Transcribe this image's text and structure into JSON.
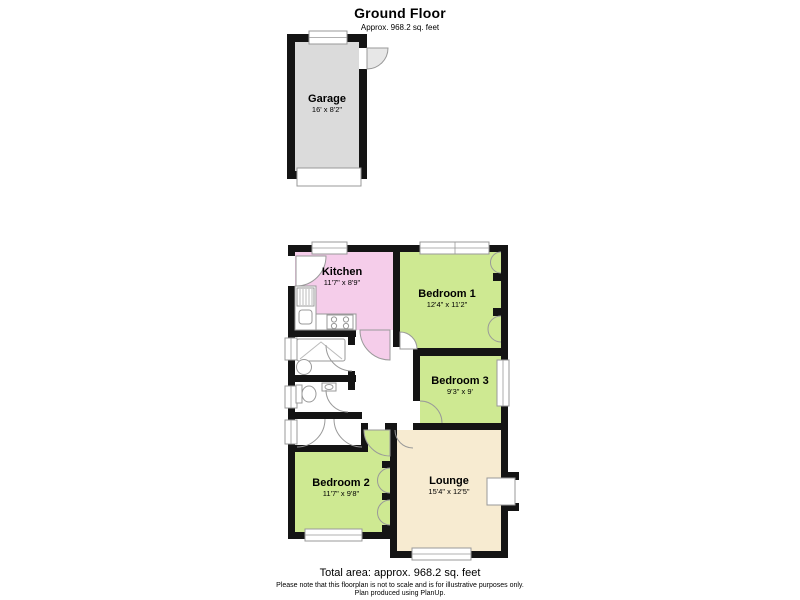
{
  "header": {
    "title": "Ground Floor",
    "subtitle": "Approx. 968.2 sq. feet"
  },
  "rooms": {
    "garage": {
      "name": "Garage",
      "dims": "16' x 8'2\""
    },
    "kitchen": {
      "name": "Kitchen",
      "dims": "11'7\" x 8'9\""
    },
    "bedroom1": {
      "name": "Bedroom 1",
      "dims": "12'4\" x 11'2\""
    },
    "bedroom3": {
      "name": "Bedroom 3",
      "dims": "9'3\" x 9'"
    },
    "bedroom2": {
      "name": "Bedroom 2",
      "dims": "11'7\" x 9'8\""
    },
    "lounge": {
      "name": "Lounge",
      "dims": "15'4\" x 12'5\""
    }
  },
  "footer": {
    "total_area": "Total area: approx. 968.2 sq. feet",
    "disclaimer_line1": "Please note that this floorplan is not to scale and is for illustrative purposes only.",
    "disclaimer_line2": "Plan produced using PlanUp."
  },
  "colors": {
    "wall": "#141414",
    "garage_floor": "#dbdbdb",
    "kitchen_floor": "#f5cdea",
    "bedroom_floor": "#cee992",
    "lounge_floor": "#f7ebd1",
    "fixture_outline": "#999999"
  }
}
